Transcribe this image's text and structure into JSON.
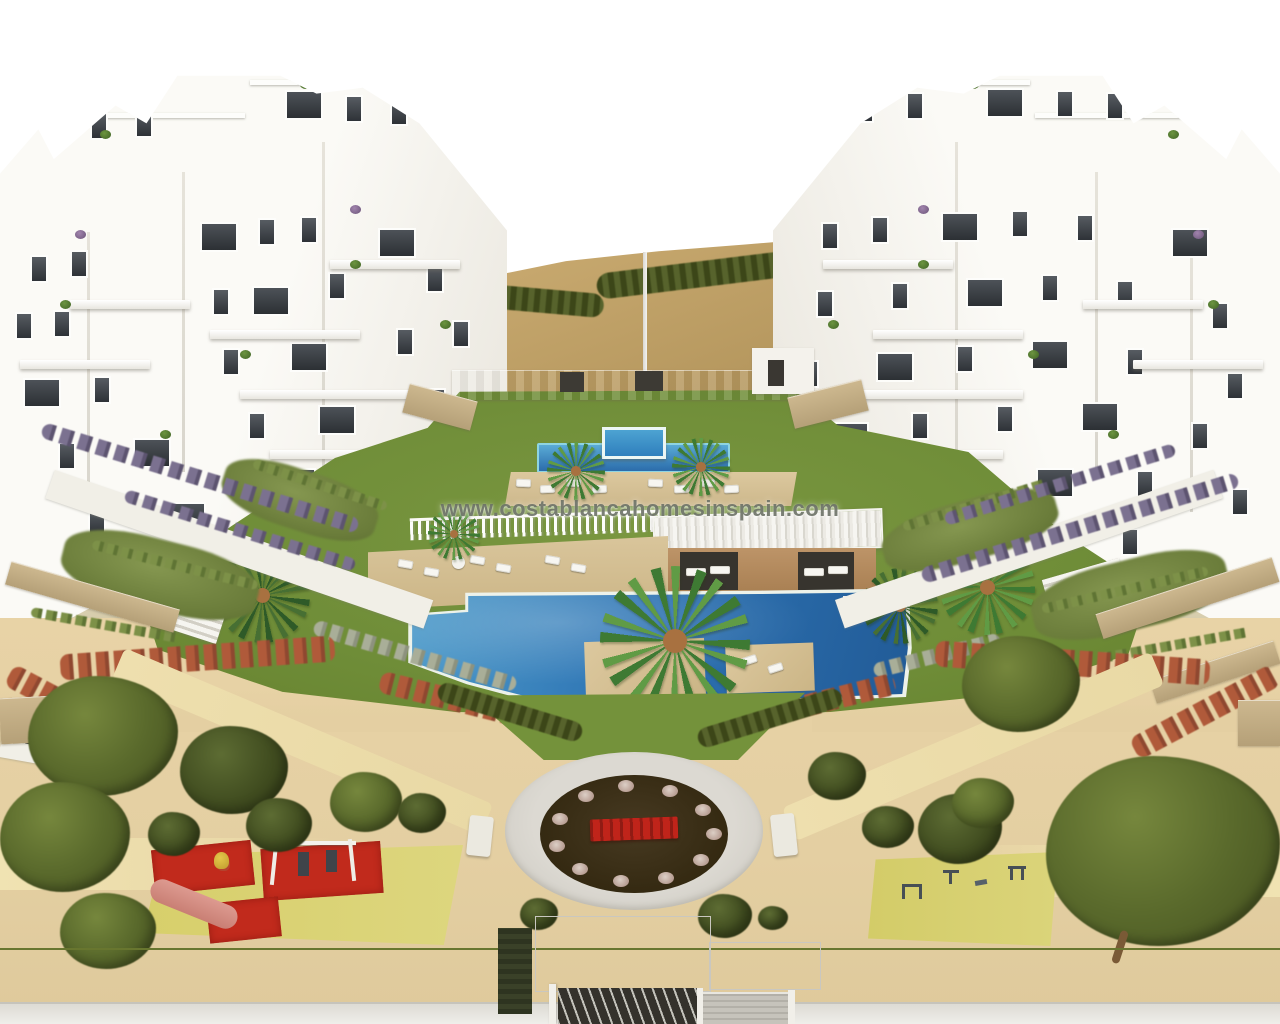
{
  "watermark": {
    "text": "www.costablancahomesinspain.com"
  },
  "scene": {
    "type": "aerial 3D architectural render",
    "subject": "Mediterranean residential complex: two white apartment buildings around a landscaped communal garden",
    "features": [
      "left apartment building",
      "right apartment building",
      "hillside embankment with hedge",
      "upper lap pool",
      "raised kids pool",
      "main swimming pool",
      "timber sun decks",
      "pergola with cabanas",
      "sun loungers",
      "central oval plaza with red bench",
      "flowering hedges",
      "palm trees",
      "olive trees",
      "children's playground with swings and slide",
      "outdoor exercise area",
      "entrance gate canopy",
      "perimeter hedge"
    ]
  },
  "palette": {
    "sky": "#ffffff",
    "building_white": "#fbfaf6",
    "window_dark": "#2e3237",
    "lawn_green": "#74923b",
    "pool_blue": "#2e74b4",
    "lap_pool_border": "#8ed4e2",
    "deck_tan": "#d6c096",
    "sand": "#e4cfa2",
    "slope_tan": "#c2a36a",
    "hedge_dark": "#4d5a1f",
    "plaza_ring": "#d6d3cc",
    "plaza_soil": "#32270f",
    "bench_red": "#c0241a",
    "playground_red": "#c12a1c",
    "playground_yellow": "#d7cf6b",
    "flower_red": "#b05a3a",
    "pergola_wood": "#b89163"
  }
}
